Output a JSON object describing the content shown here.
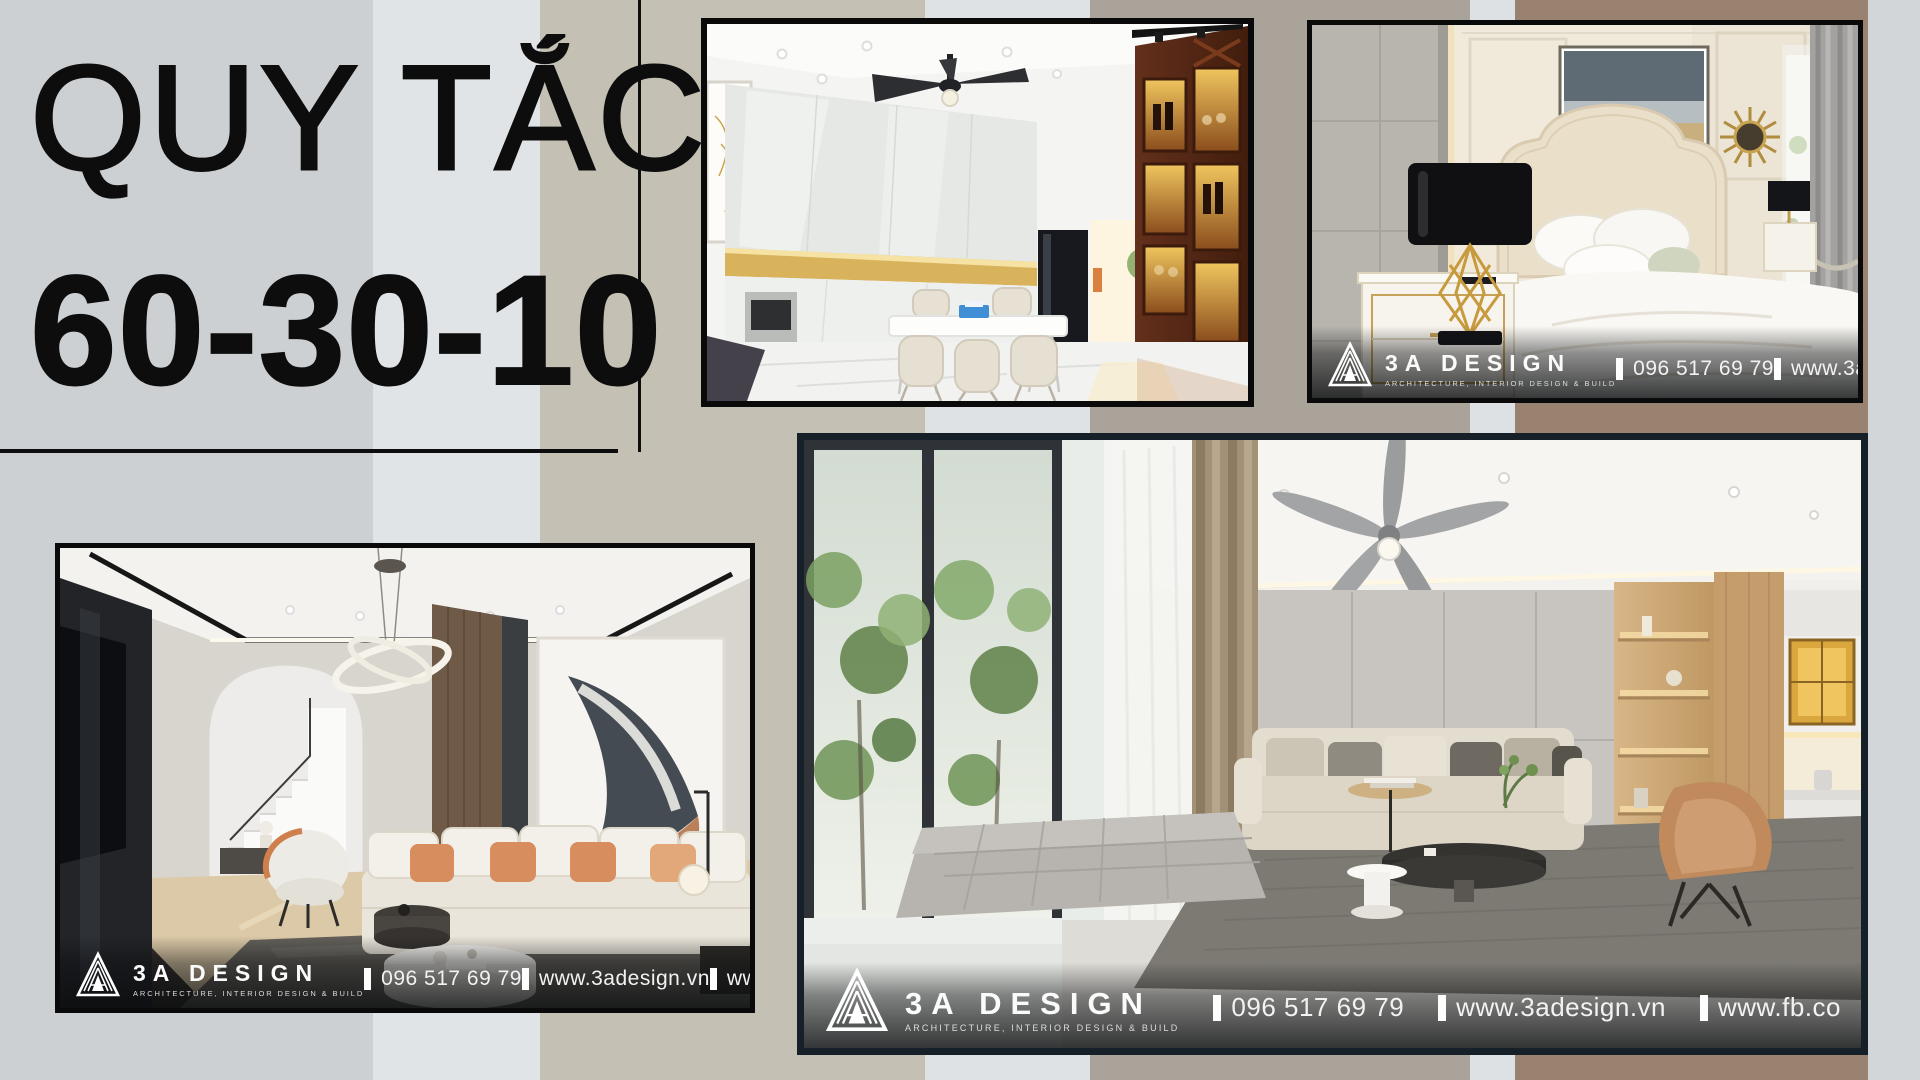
{
  "title": {
    "line1": "QUY TẮC",
    "line2": "60-30-10"
  },
  "photos": {
    "kitchen": {
      "subject": "kitchen-dining-room-render"
    },
    "bedroom": {
      "subject": "neoclassical-bedroom-render",
      "brand": "3A DESIGN",
      "tagline": "ARCHITECTURE, INTERIOR DESIGN & BUILD",
      "phone": "096 517 69 79",
      "website": "www.3adesi"
    },
    "living": {
      "subject": "townhouse-living-room-render",
      "brand": "3A DESIGN",
      "tagline": "ARCHITECTURE, INTERIOR DESIGN & BUILD",
      "phone": "096 517 69 79",
      "website": "www.3adesign.vn",
      "facebook": "www.fb.com/3adesign.v"
    },
    "main": {
      "subject": "modern-living-room-render",
      "brand": "3A DESIGN",
      "tagline": "ARCHITECTURE, INTERIOR DESIGN & BUILD",
      "phone": "096 517 69 79",
      "website": "www.3adesign.vn",
      "facebook": "www.fb.co"
    }
  },
  "palette": {
    "stripes": [
      "#cdd0d2",
      "#e0e4e6",
      "#c4c0b4",
      "#dee2e4",
      "#a9a399",
      "#dde1e3",
      "#9a8270",
      "#d3d6d8"
    ],
    "title_color": "#0d0d0d",
    "photo_border": "#0a0a0a",
    "main_photo_border": "#152028",
    "watermark_text": "#f7f7f7",
    "accent_wood": "#5f2b17",
    "accent_amber": "#d9a840",
    "accent_orange": "#d78d5e"
  },
  "icons": {
    "logo": "3a-design-triangle-logo",
    "separator": "vertical-tick"
  }
}
